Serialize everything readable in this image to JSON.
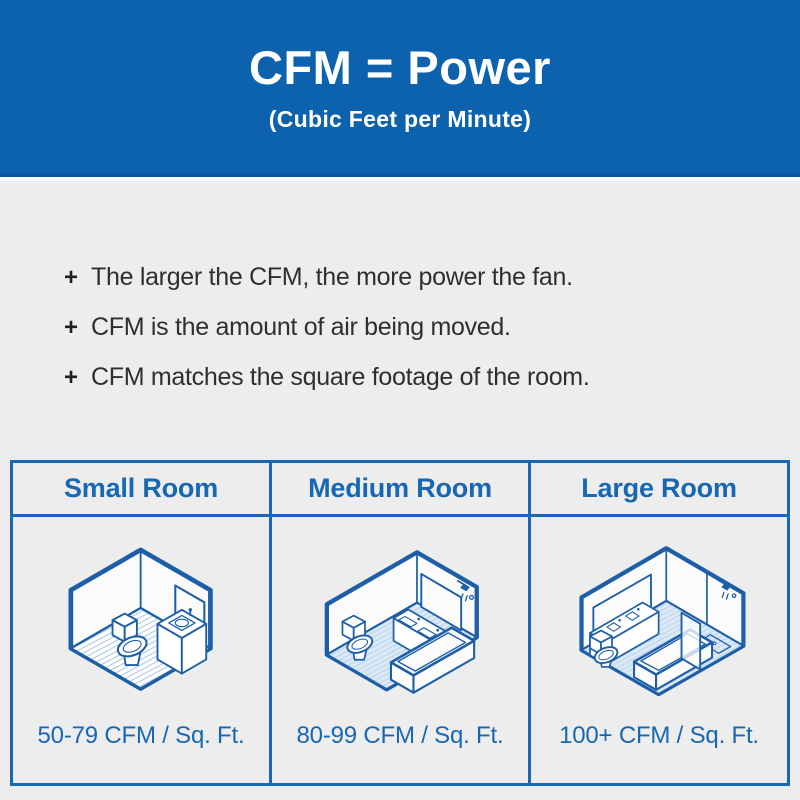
{
  "header": {
    "title": "CFM = Power",
    "subtitle": "(Cubic Feet per Minute)"
  },
  "bullets": [
    {
      "marker": "+",
      "text": "The larger the CFM, the more power the fan."
    },
    {
      "marker": "+",
      "text": "CFM is the amount of air being moved."
    },
    {
      "marker": "+",
      "text": "CFM matches the square footage of the room."
    }
  ],
  "table": {
    "columns": [
      {
        "header": "Small Room",
        "illustration": "small-bathroom-isometric-icon",
        "cfm": "50-79 CFM / Sq. Ft."
      },
      {
        "header": "Medium Room",
        "illustration": "medium-bathroom-isometric-icon",
        "cfm": "80-99 CFM / Sq. Ft."
      },
      {
        "header": "Large Room",
        "illustration": "large-bathroom-isometric-icon",
        "cfm": "100+ CFM / Sq. Ft."
      }
    ]
  },
  "colors": {
    "banner_blue": "#0d62ae",
    "table_border_blue": "#1767b2",
    "illustration_line_blue": "#1d5fa7",
    "floor_tint_blue": "#dbe8f6",
    "background_gray": "#ededee",
    "body_text_dark": "#2f2f2f",
    "banner_text_white": "#ffffff"
  }
}
